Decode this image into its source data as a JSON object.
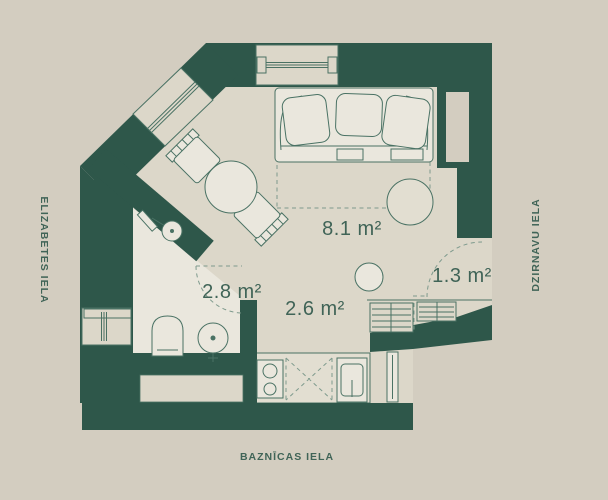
{
  "plan": {
    "streets": {
      "left": "ELIZABETES IELA",
      "right": "DZIRNAVU IELA",
      "bottom": "BAZNĪCAS IELA"
    },
    "rooms": [
      {
        "id": "living-room",
        "area": "8.1 m²"
      },
      {
        "id": "bathroom",
        "area": "2.8 m²"
      },
      {
        "id": "hallway-kitchen",
        "area": "2.6 m²"
      },
      {
        "id": "balcony-nook",
        "area": "1.3 m²"
      }
    ],
    "colors": {
      "background": "#d3cdc0",
      "floor": "#dcd7c9",
      "floor_light": "#eae7dd",
      "counter": "#e2ded1",
      "wall": "#2e574a",
      "line": "#4a7264",
      "dash": "#7e9a8d",
      "text": "#406457"
    }
  }
}
